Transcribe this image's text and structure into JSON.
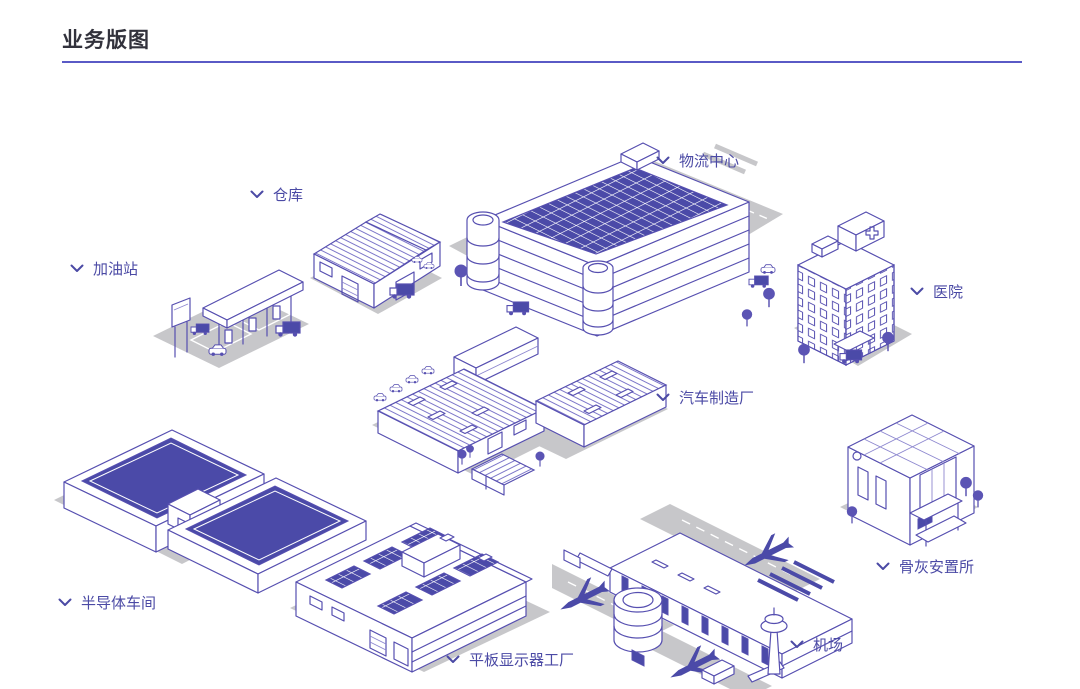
{
  "page": {
    "title": "业务版图"
  },
  "colors": {
    "title_text": "#32323c",
    "divider": "#5a5ac6",
    "label_text": "#4b4aa5",
    "line_art": "#564fb0",
    "panel_fill": "#4b4aa8",
    "ground_shadow": "#c7c7ca",
    "background": "#ffffff"
  },
  "icons": {
    "label_chevron": "chevron-down"
  },
  "sites": [
    {
      "id": "gas-station",
      "label": "加油站"
    },
    {
      "id": "warehouse",
      "label": "仓库"
    },
    {
      "id": "logistics-center",
      "label": "物流中心"
    },
    {
      "id": "hospital",
      "label": "医院"
    },
    {
      "id": "auto-factory",
      "label": "汽车制造厂"
    },
    {
      "id": "columbarium",
      "label": "骨灰安置所"
    },
    {
      "id": "semiconductor-workshop",
      "label": "半导体车间"
    },
    {
      "id": "flat-panel-factory",
      "label": "平板显示器工厂"
    },
    {
      "id": "airport",
      "label": "机场"
    }
  ]
}
